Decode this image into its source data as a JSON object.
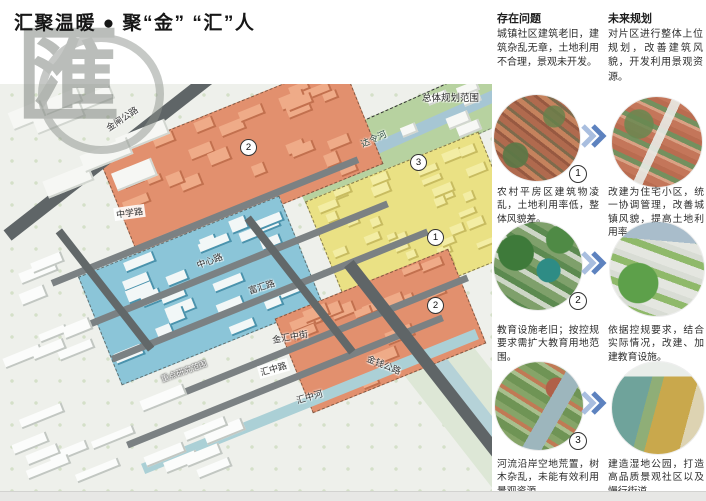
{
  "page": {
    "title": "汇聚温暖 ● 聚“金” “汇”人",
    "watermark_glyph": "匯"
  },
  "map": {
    "labels": {
      "jinzha_road": "金闸公路",
      "zhongxue_road": "中学路",
      "zhongxin_road": "中心路",
      "fuhui_road": "富汇路",
      "jinhui_mid_street": "金汇中街",
      "huizhong_road": "汇中路",
      "huizhong_river": "汇中河",
      "jinqian_road": "金钱公路",
      "daling_river": "达令河",
      "overall_scope": "总体规划范围",
      "key_study_scope": "重点研究范围"
    },
    "badges": {
      "one": "1",
      "two": "2",
      "three": "3"
    },
    "zone_colors": {
      "village": "#eae184",
      "education": "#e2906e",
      "street": "#8bc5d8",
      "river_corridor": "#b7d2a0"
    }
  },
  "panel": {
    "problems": {
      "title": "存在问题",
      "intro": "城镇社区建筑老旧，建筑杂乱无章，土地利用不合理，景观未开发。"
    },
    "plans": {
      "title": "未来规划",
      "intro": "对片区进行整体上位规划，改善建筑风貌，开发利用景观资源。"
    },
    "rows": [
      {
        "num": "1",
        "problem": "农村平房区建筑物凌乱，土地利用率低，整体风貌差。",
        "plan": "改建为住宅小区，统一协调管理，改善城镇风貌，提高土地利用率。"
      },
      {
        "num": "2",
        "problem": "教育设施老旧；按控规要求需扩大教育用地范围。",
        "plan": "依据控规要求，结合实际情况，改建、加建教育设施。"
      },
      {
        "num": "3",
        "problem": "河流沿岸空地荒置，树木杂乱，未能有效利用景观资源。",
        "plan": "建造湿地公园，打造高品质景观社区以及慢行街道。"
      }
    ],
    "arrow_color": "#5d82bf"
  }
}
